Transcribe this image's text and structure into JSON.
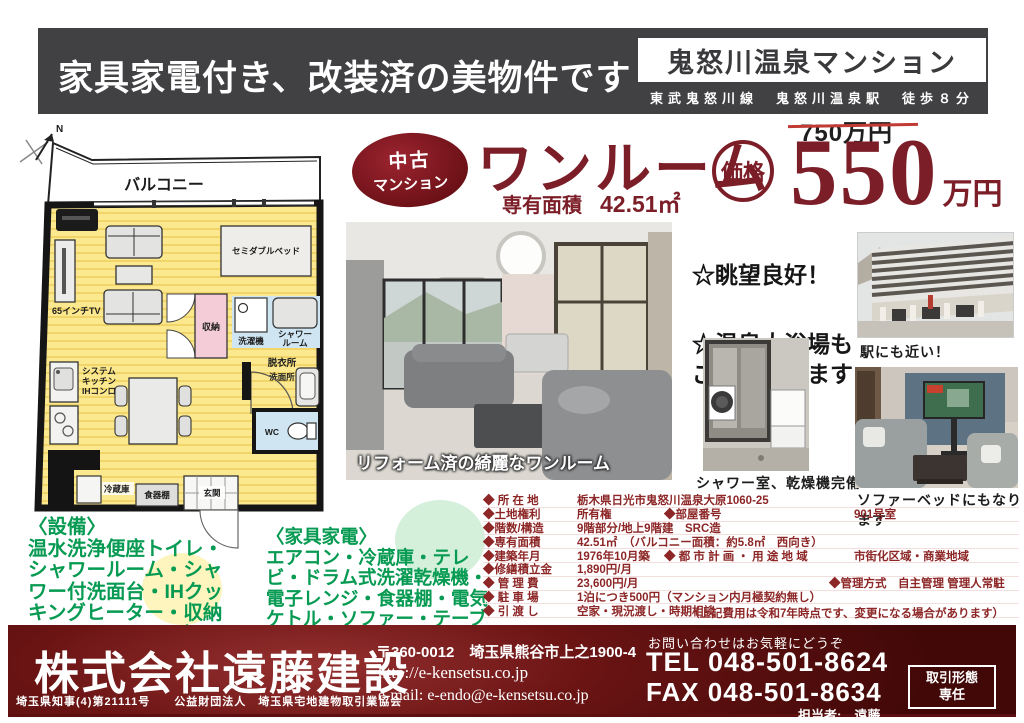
{
  "header": {
    "headline": "家具家電付き、改装済の美物件です",
    "property_name": "鬼怒川温泉マンション",
    "access": "東武鬼怒川線　鬼怒川温泉駅　徒歩８分"
  },
  "listing": {
    "badge_line1": "中古",
    "badge_line2": "マンション",
    "type": "ワンルーム",
    "area_label": "専有面積",
    "area_value": "42.51㎡",
    "price_label": "価格",
    "old_price": "750万円",
    "price": "550",
    "price_unit": "万円",
    "accent_color": "#7c1e28"
  },
  "highlights": {
    "item1": "☆眺望良好！",
    "item2": "☆温泉大浴場も\nご利用できます"
  },
  "photos": {
    "main_caption": "リフォーム済の綺麗なワンルーム",
    "building_caption": "駅にも近い！",
    "shower_caption": "シャワー室、乾燥機完備",
    "sofa_caption": "ソファーベッドにもなります"
  },
  "floorplan": {
    "north_label": "N",
    "balcony": "バルコニー",
    "bed": "セミダブルベッド",
    "tv": "65インチTV",
    "closet": "収納",
    "washer": "洗濯機",
    "shower_l1": "シャワー",
    "shower_l2": "ルーム",
    "dressing": "脱衣所",
    "washroom": "洗面所",
    "wc": "WC",
    "kitchen_l1": "システム",
    "kitchen_l2": "キッチン",
    "kitchen_l3": "IHコンロ",
    "fridge": "冷蔵庫",
    "cupboard": "食器棚",
    "entrance": "玄関"
  },
  "equipment": {
    "title": "〈設備〉",
    "items": "温水洗浄便座トイレ・シャワールーム・シャワー付洗面台・IHクッキングヒーター・収納スペース・照明電気"
  },
  "furniture": {
    "title": "〈家具家電〉",
    "items": "エアコン・冷蔵庫・テレビ・ドラム式洗濯乾燥機・電子レンジ・食器棚・電気ケトル・ソファー・テーブル・ベッド・カーテン"
  },
  "details": {
    "rows": [
      {
        "c1": "◆ 所 在 地",
        "v1": "栃木県日光市鬼怒川温泉大原1060-25"
      },
      {
        "c1": "◆土地権利",
        "v1": "所有権",
        "c2": "◆部屋番号",
        "v2": "901号室"
      },
      {
        "c1": "◆階数/構造",
        "v1": "9階部分/地上9階建　SRC造"
      },
      {
        "c1": "◆専有面積",
        "v1": "42.51㎡　（バルコニー面積：約5.8㎡　西向き）"
      },
      {
        "c1": "◆建築年月",
        "v1": "1976年10月築",
        "c2": "◆ 都 市 計 画 ・ 用 途 地 域",
        "v2": "市街化区域・商業地域"
      },
      {
        "c1": "◆修繕積立金",
        "v1": "1,890円/月"
      },
      {
        "c1": "◆ 管 理 費",
        "v1": "23,600円/月",
        "c2": "◆管理方式　自主管理 管理人常駐",
        "v2": ""
      },
      {
        "c1": "◆ 駐 車 場",
        "v1": "1泊につき500円（マンション内月極契約無し）"
      },
      {
        "c1": "◆ 引 渡 し",
        "v1": "空家・現況渡し・時期相談"
      }
    ],
    "note": "（上記費用は令和7年時点です、変更になる場合があります）"
  },
  "footer": {
    "company": "株式会社遠藤建設",
    "license": "埼玉県知事(4)第21111号　　公益財団法人　埼玉県宅地建物取引業協会",
    "postal": "〒360-0012　埼玉県熊谷市上之1900-4",
    "url": "http://e-kensetsu.co.jp",
    "email": "e-mail: e-endo@e-kensetsu.co.jp",
    "contact_note": "お問い合わせはお気軽にどうぞ",
    "tel": "TEL 048-501-8624",
    "fax": "FAX 048-501-8634",
    "agent": "担当者:　遠藤",
    "deal_type_label": "取引形態",
    "deal_type_value": "専任"
  }
}
